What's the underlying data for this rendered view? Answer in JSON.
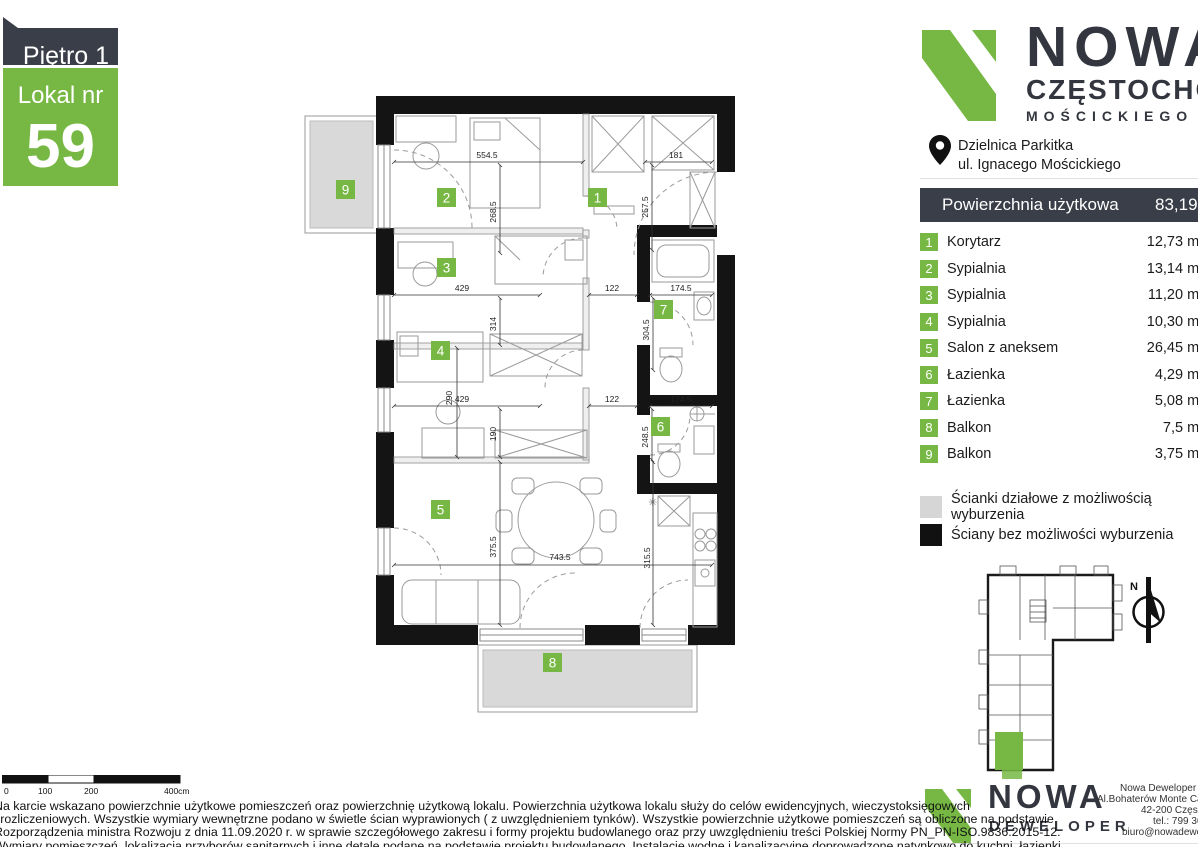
{
  "colors": {
    "green": "#76b843",
    "dark": "#3a3e48",
    "balcony_gray": "#d9d9d9",
    "legend_gray": "#d6d6d6"
  },
  "badge": {
    "floor_label": "Piętro 1",
    "unit_label": "Lokal nr",
    "unit_number": "59"
  },
  "brand": {
    "name_line": "NOWA",
    "city_line": "CZĘSTOCHOWA",
    "street_line": "MOŚCICKIEGO",
    "location_line1": "Dzielnica Parkitka",
    "location_line2": "ul. Ignacego Mościckiego"
  },
  "area_table": {
    "header_label": "Powierzchnia użytkowa",
    "header_value": "83,19m²",
    "rows": [
      {
        "num": "1",
        "name": "Korytarz",
        "area": "12,73 m²"
      },
      {
        "num": "2",
        "name": "Sypialnia",
        "area": "13,14 m²"
      },
      {
        "num": "3",
        "name": "Sypialnia",
        "area": "11,20 m²"
      },
      {
        "num": "4",
        "name": "Sypialnia",
        "area": "10,30 m²"
      },
      {
        "num": "5",
        "name": "Salon z aneksem",
        "area": "26,45 m²"
      },
      {
        "num": "6",
        "name": "Łazienka",
        "area": "4,29 m²"
      },
      {
        "num": "7",
        "name": "Łazienka",
        "area": "5,08 m²"
      },
      {
        "num": "8",
        "name": "Balkon",
        "area": "7,5 m²"
      },
      {
        "num": "9",
        "name": "Balkon",
        "area": "3,75 m²"
      }
    ]
  },
  "legend": {
    "partition_label": "Ścianki działowe z możliwością wyburzenia",
    "structural_label": "Ściany bez możliwości wyburzenia"
  },
  "floor_plan": {
    "room_badges": [
      {
        "num": "1",
        "x": 588,
        "y": 188
      },
      {
        "num": "2",
        "x": 437,
        "y": 188
      },
      {
        "num": "3",
        "x": 437,
        "y": 258
      },
      {
        "num": "4",
        "x": 431,
        "y": 341
      },
      {
        "num": "5",
        "x": 431,
        "y": 500
      },
      {
        "num": "6",
        "x": 651,
        "y": 417
      },
      {
        "num": "7",
        "x": 654,
        "y": 300
      },
      {
        "num": "8",
        "x": 543,
        "y": 653
      },
      {
        "num": "9",
        "x": 336,
        "y": 180
      }
    ],
    "dimensions": [
      {
        "label": "554.5",
        "x": 487,
        "y": 158,
        "rot": 0
      },
      {
        "label": "181",
        "x": 676,
        "y": 158,
        "rot": 0
      },
      {
        "label": "268.5",
        "x": 496,
        "y": 212,
        "rot": -90
      },
      {
        "label": "257.5",
        "x": 648,
        "y": 207,
        "rot": -90
      },
      {
        "label": "429",
        "x": 462,
        "y": 291,
        "rot": 0
      },
      {
        "label": "122",
        "x": 612,
        "y": 291,
        "rot": 0
      },
      {
        "label": "174.5",
        "x": 681,
        "y": 291,
        "rot": 0
      },
      {
        "label": "314",
        "x": 496,
        "y": 324,
        "rot": -90
      },
      {
        "label": "304.5",
        "x": 649,
        "y": 330,
        "rot": -90
      },
      {
        "label": "290",
        "x": 452,
        "y": 398,
        "rot": -90
      },
      {
        "label": "429",
        "x": 462,
        "y": 402,
        "rot": 0
      },
      {
        "label": "122",
        "x": 612,
        "y": 402,
        "rot": 0
      },
      {
        "label": "174.5",
        "x": 681,
        "y": 402,
        "rot": 0
      },
      {
        "label": "190",
        "x": 496,
        "y": 434,
        "rot": -90
      },
      {
        "label": "248.5",
        "x": 648,
        "y": 437,
        "rot": -90
      },
      {
        "label": "375.5",
        "x": 496,
        "y": 547,
        "rot": -90
      },
      {
        "label": "743.5",
        "x": 560,
        "y": 560,
        "rot": 0
      },
      {
        "label": "315.5",
        "x": 650,
        "y": 558,
        "rot": -90
      }
    ],
    "scale_bar": {
      "labels": [
        {
          "text": "0",
          "x": 4
        },
        {
          "text": "100",
          "x": 38
        },
        {
          "text": "200",
          "x": 84
        },
        {
          "text": "400cm",
          "x": 164
        }
      ]
    }
  },
  "mini_map": {
    "north_label": "N"
  },
  "footer": {
    "logo_line1": "NOWA",
    "logo_line2": "DEWELOPER",
    "contact_lines": [
      {
        "text": "Nowa Deweloper sp",
        "x": 1120,
        "y": 783
      },
      {
        "text": "Al.Bohaterów Monte Cass",
        "x": 1097,
        "y": 794
      },
      {
        "text": "42-200 Często",
        "x": 1141,
        "y": 805
      },
      {
        "text": "tel.: 799 36",
        "x": 1153,
        "y": 816
      },
      {
        "text": "biuro@nowadewel",
        "x": 1122,
        "y": 827
      }
    ]
  },
  "disclaimer": {
    "lines": [
      "Na karcie wskazano  powierzchnie  użytkowe pomieszczeń oraz powierzchnię użytkową lokalu. Powierzchnia użytkowa lokalu służy do celów ewidencyjnych, wieczystoksięgowych",
      "i rozliczeniowych.  Wszystkie wymiary wewnętrzne podano w świetle ścian wyprawionych ( z uwzględnieniem tynków).  Wszystkie powierzchnie użytkowe pomieszczeń są obliczone na podstawie",
      "Rozporządzenia ministra Rozwoju z dnia 11.09.2020 r. w sprawie szczegółowego zakresu i formy projektu budowlanego oraz przy uwzględnieniu treści Polskiej Normy PN_PN-ISO.9836:2015-12.",
      "Wymiary pomieszczeń, lokalizacja przyborów sanitarnych i inne detale podane na podstawie projektu budowlanego. Instalacje wodne i kanalizacyjne doprowadzone natynkowo do kuchni, łazienki"
    ]
  }
}
